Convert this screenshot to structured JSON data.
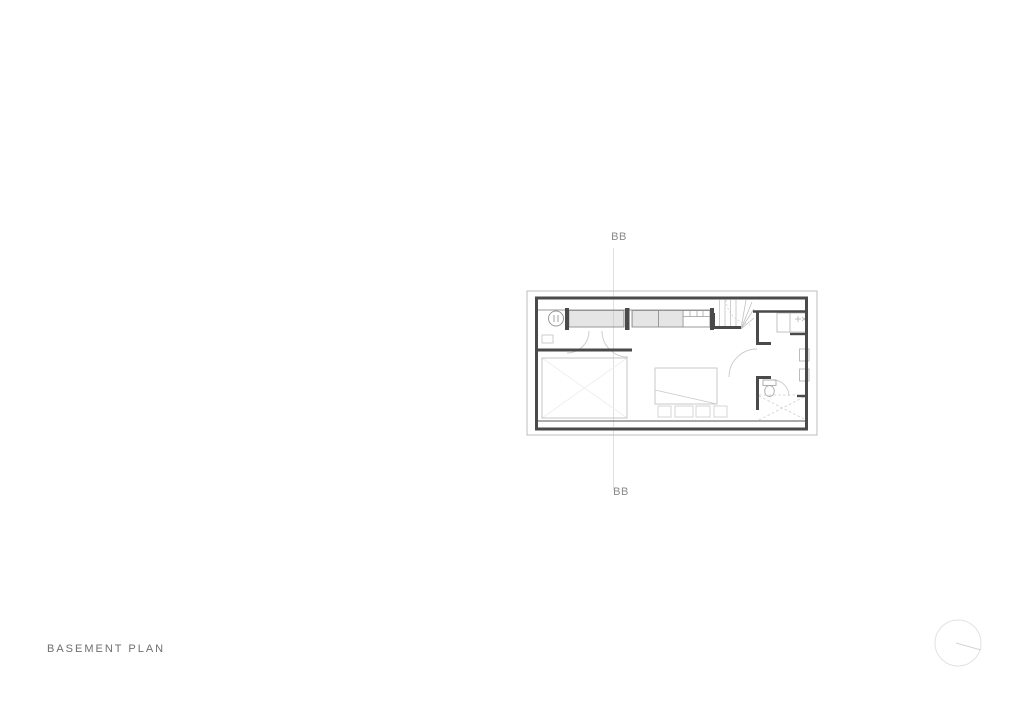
{
  "page": {
    "title": "BASEMENT PLAN",
    "background_color": "#ffffff"
  },
  "section_markers": {
    "top_label": "BB",
    "bottom_label": "BB"
  },
  "drawing": {
    "kind": "architectural basement floor plan",
    "visible_features": [
      "exterior-cut-walls",
      "floor-slab-outline",
      "section-line-BB",
      "wardrobe-cabinets-hatched",
      "washer-drum-symbol",
      "winder-stair",
      "storage-room-cross",
      "bed-with-throw",
      "bench-cushions",
      "bathroom-toilet",
      "shower-dashed-cross",
      "vanity-counter-sink",
      "door-swing-arcs",
      "wall-mounted-fixtures"
    ],
    "colors": {
      "wall_cut": "#4a4a4a",
      "medium_line": "#8f8f8f",
      "light_line": "#c6c6c6",
      "faint_line": "#ededed",
      "section_line": "#e0e0e0",
      "marker_text": "#8a8a8a",
      "title_text": "#6f6f6f"
    }
  },
  "north_indicator": {
    "icon": "north-circle-icon"
  }
}
